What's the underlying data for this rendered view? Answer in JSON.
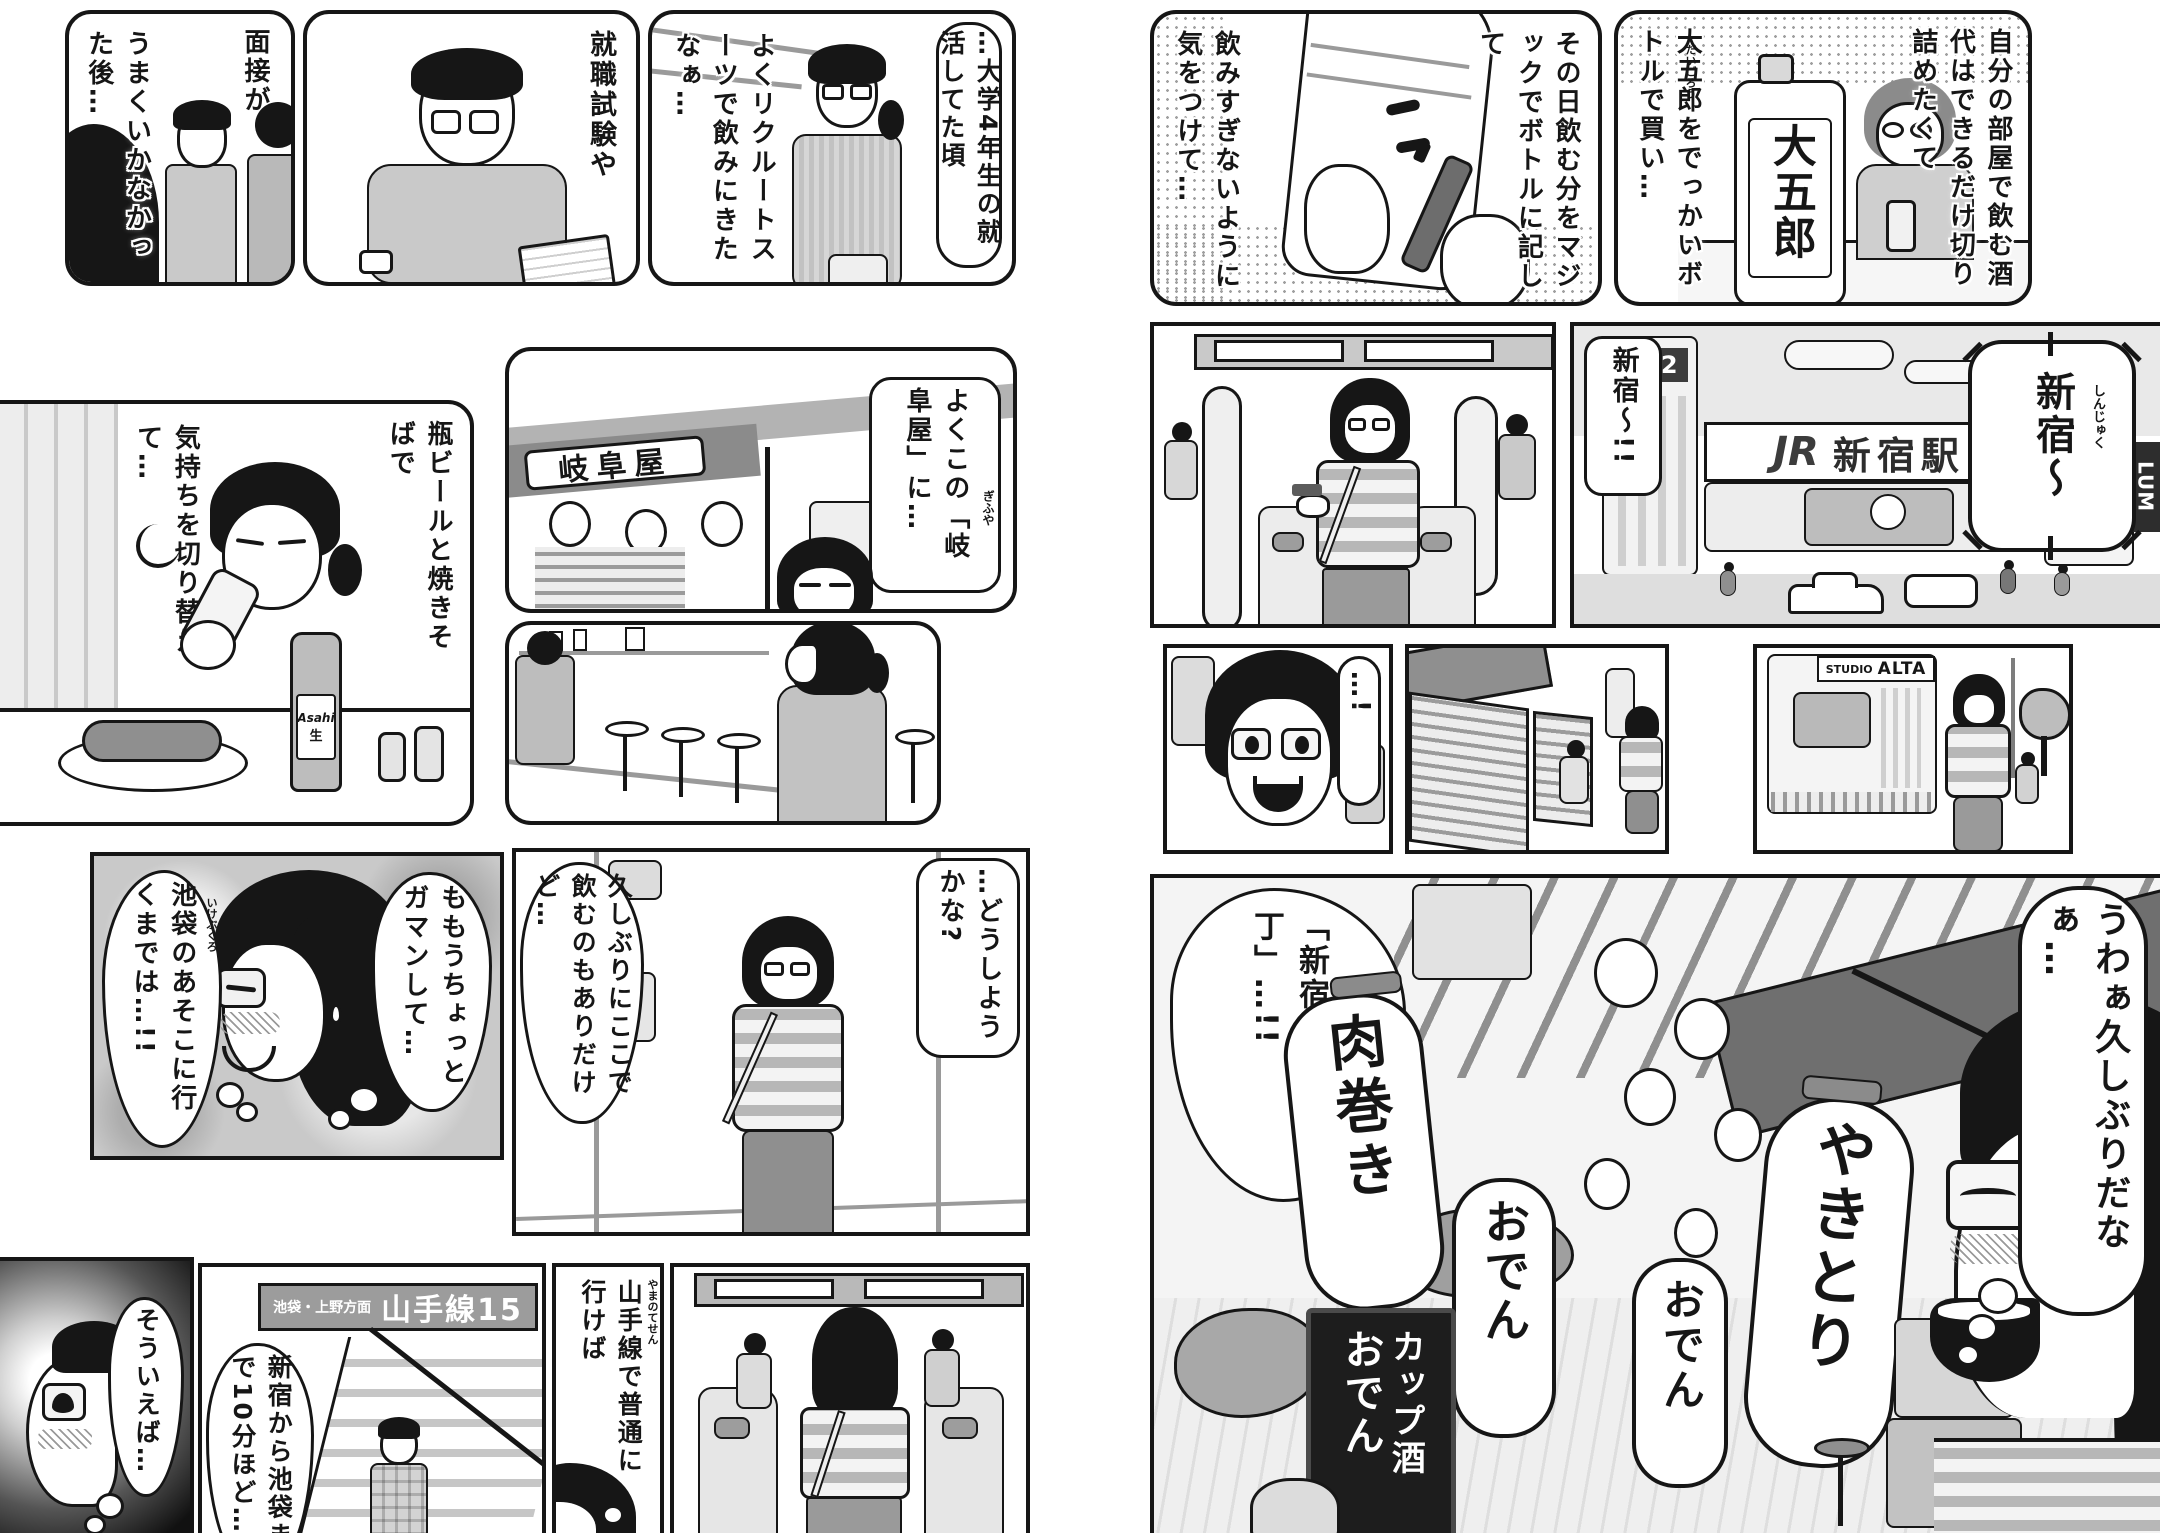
{
  "colors": {
    "ink": "#161616",
    "paper": "#ffffff",
    "halftone": "#d8d8d8"
  },
  "left": {
    "recruit": {
      "cap_right": "…大学4年生の就活してた頃",
      "cap_left": "よくリクルートスーツで飲みにきたなぁ…"
    },
    "exam": {
      "cap": "就職試験や"
    },
    "interview": {
      "cap_right": "面接が",
      "cap_left": "うまくいかなかった後…"
    },
    "gifuya": {
      "bubble": "よくこの「岐阜屋」に…",
      "furigana": "ぎふや",
      "sign": "岐阜屋"
    },
    "drink": {
      "cap_right": "瓶ビールと焼きそばで",
      "cap_left": "気持ちを切り替えて…",
      "bottle_brand": "Asahi",
      "bottle_sub": "生"
    },
    "alley": {
      "bubble_right": "…どうしようかな?",
      "bubble_left": "久しぶりにここで飲むのもありだけど…"
    },
    "gaman": {
      "bubble_right": "ももうちょっとガマンして…",
      "bubble_left": "池袋のあそこに行くまでは…!!",
      "furigana": "いけぶくろ"
    },
    "souieba": {
      "bubble": "そういえば…"
    },
    "stairs": {
      "sign_small": "池袋・上野方面",
      "sign_big": "山手線15",
      "bubble": "新宿から池袋まで10分ほど…"
    },
    "faceup": {
      "bubble": "山手線で普通に行けば",
      "furigana": "やまのてせん"
    }
  },
  "right": {
    "marking": {
      "cap_right": "その日飲む分をマジックでボトルに記して",
      "cap_left": "飲みすぎないように気をつけて…"
    },
    "daigoro": {
      "cap_right": "自分の部屋で飲む酒代はできるだけ切り詰めたくて",
      "cap_left": "大五郎をでっかいボトルで買い…",
      "furigana": "だいごろう",
      "label": "大五郎"
    },
    "station": {
      "bubble": "新宿〜!!",
      "burst": "新宿〜",
      "burst_furigana": "しんじゅく",
      "sign_jr": "JR",
      "sign_station": "新宿駅",
      "sign_ne2": "NE2",
      "sign_lum": "LUM"
    },
    "dotface": {
      "bubble": "…!"
    },
    "alta": {
      "sign_studio": "STUDIO",
      "sign_alta": "ALTA"
    },
    "yokocho": {
      "narration": "「新宿思い出横丁」…!!",
      "lantern_nikumaki": "肉巻き",
      "lantern_oden1": "おでん",
      "lantern_yakitori": "やきとり",
      "lantern_oden2": "おでん",
      "board_line1": "おでん",
      "board_line2": "カップ酒",
      "thought": "うわぁ久しぶりだなぁ…"
    }
  }
}
